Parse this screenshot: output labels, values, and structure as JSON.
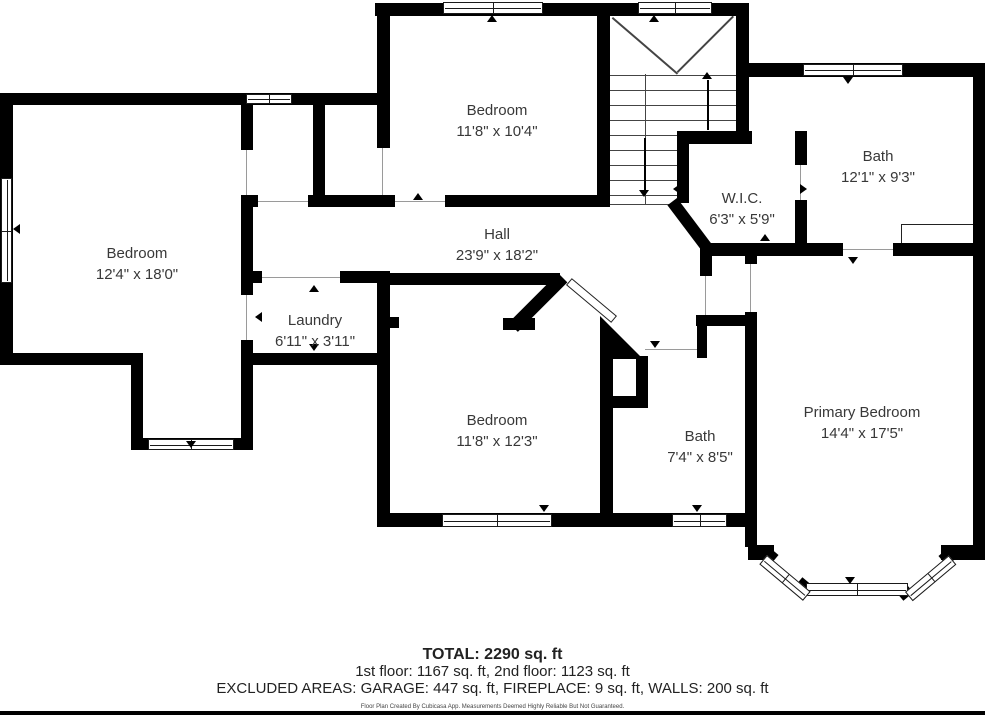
{
  "rooms": [
    {
      "name": "Bedroom",
      "dims": "11'8\" x 10'4\""
    },
    {
      "name": "Bath",
      "dims": "12'1\" x 9'3\""
    },
    {
      "name": "W.I.C.",
      "dims": "6'3\" x 5'9\""
    },
    {
      "name": "Hall",
      "dims": "23'9\" x 18'2\""
    },
    {
      "name": "Bedroom",
      "dims": "12'4\" x 18'0\""
    },
    {
      "name": "Laundry",
      "dims": "6'11\" x 3'11\""
    },
    {
      "name": "Bedroom",
      "dims": "11'8\" x 12'3\""
    },
    {
      "name": "Bath",
      "dims": "7'4\" x 8'5\""
    },
    {
      "name": "Primary Bedroom",
      "dims": "14'4\" x 17'5\""
    }
  ],
  "footer": {
    "total": "TOTAL: 2290 sq. ft",
    "floors": "1st floor: 1167 sq. ft, 2nd floor: 1123 sq. ft",
    "excluded": "EXCLUDED AREAS: GARAGE: 447 sq. ft, FIREPLACE: 9 sq. ft, WALLS: 200 sq. ft",
    "disclaimer": "Floor Plan Created By Cubicasa App. Measurements Deemed Highly Reliable But Not Guaranteed."
  },
  "colors": {
    "wall": "#000000",
    "label_text": "#383838",
    "background": "#ffffff",
    "door_line": "#9a9a9a"
  },
  "markers": {
    "door_arrow": "small black triangle at door openings",
    "window_marker": "small black triangle at window centers",
    "stair_direction": "up and down arrows on staircase"
  }
}
